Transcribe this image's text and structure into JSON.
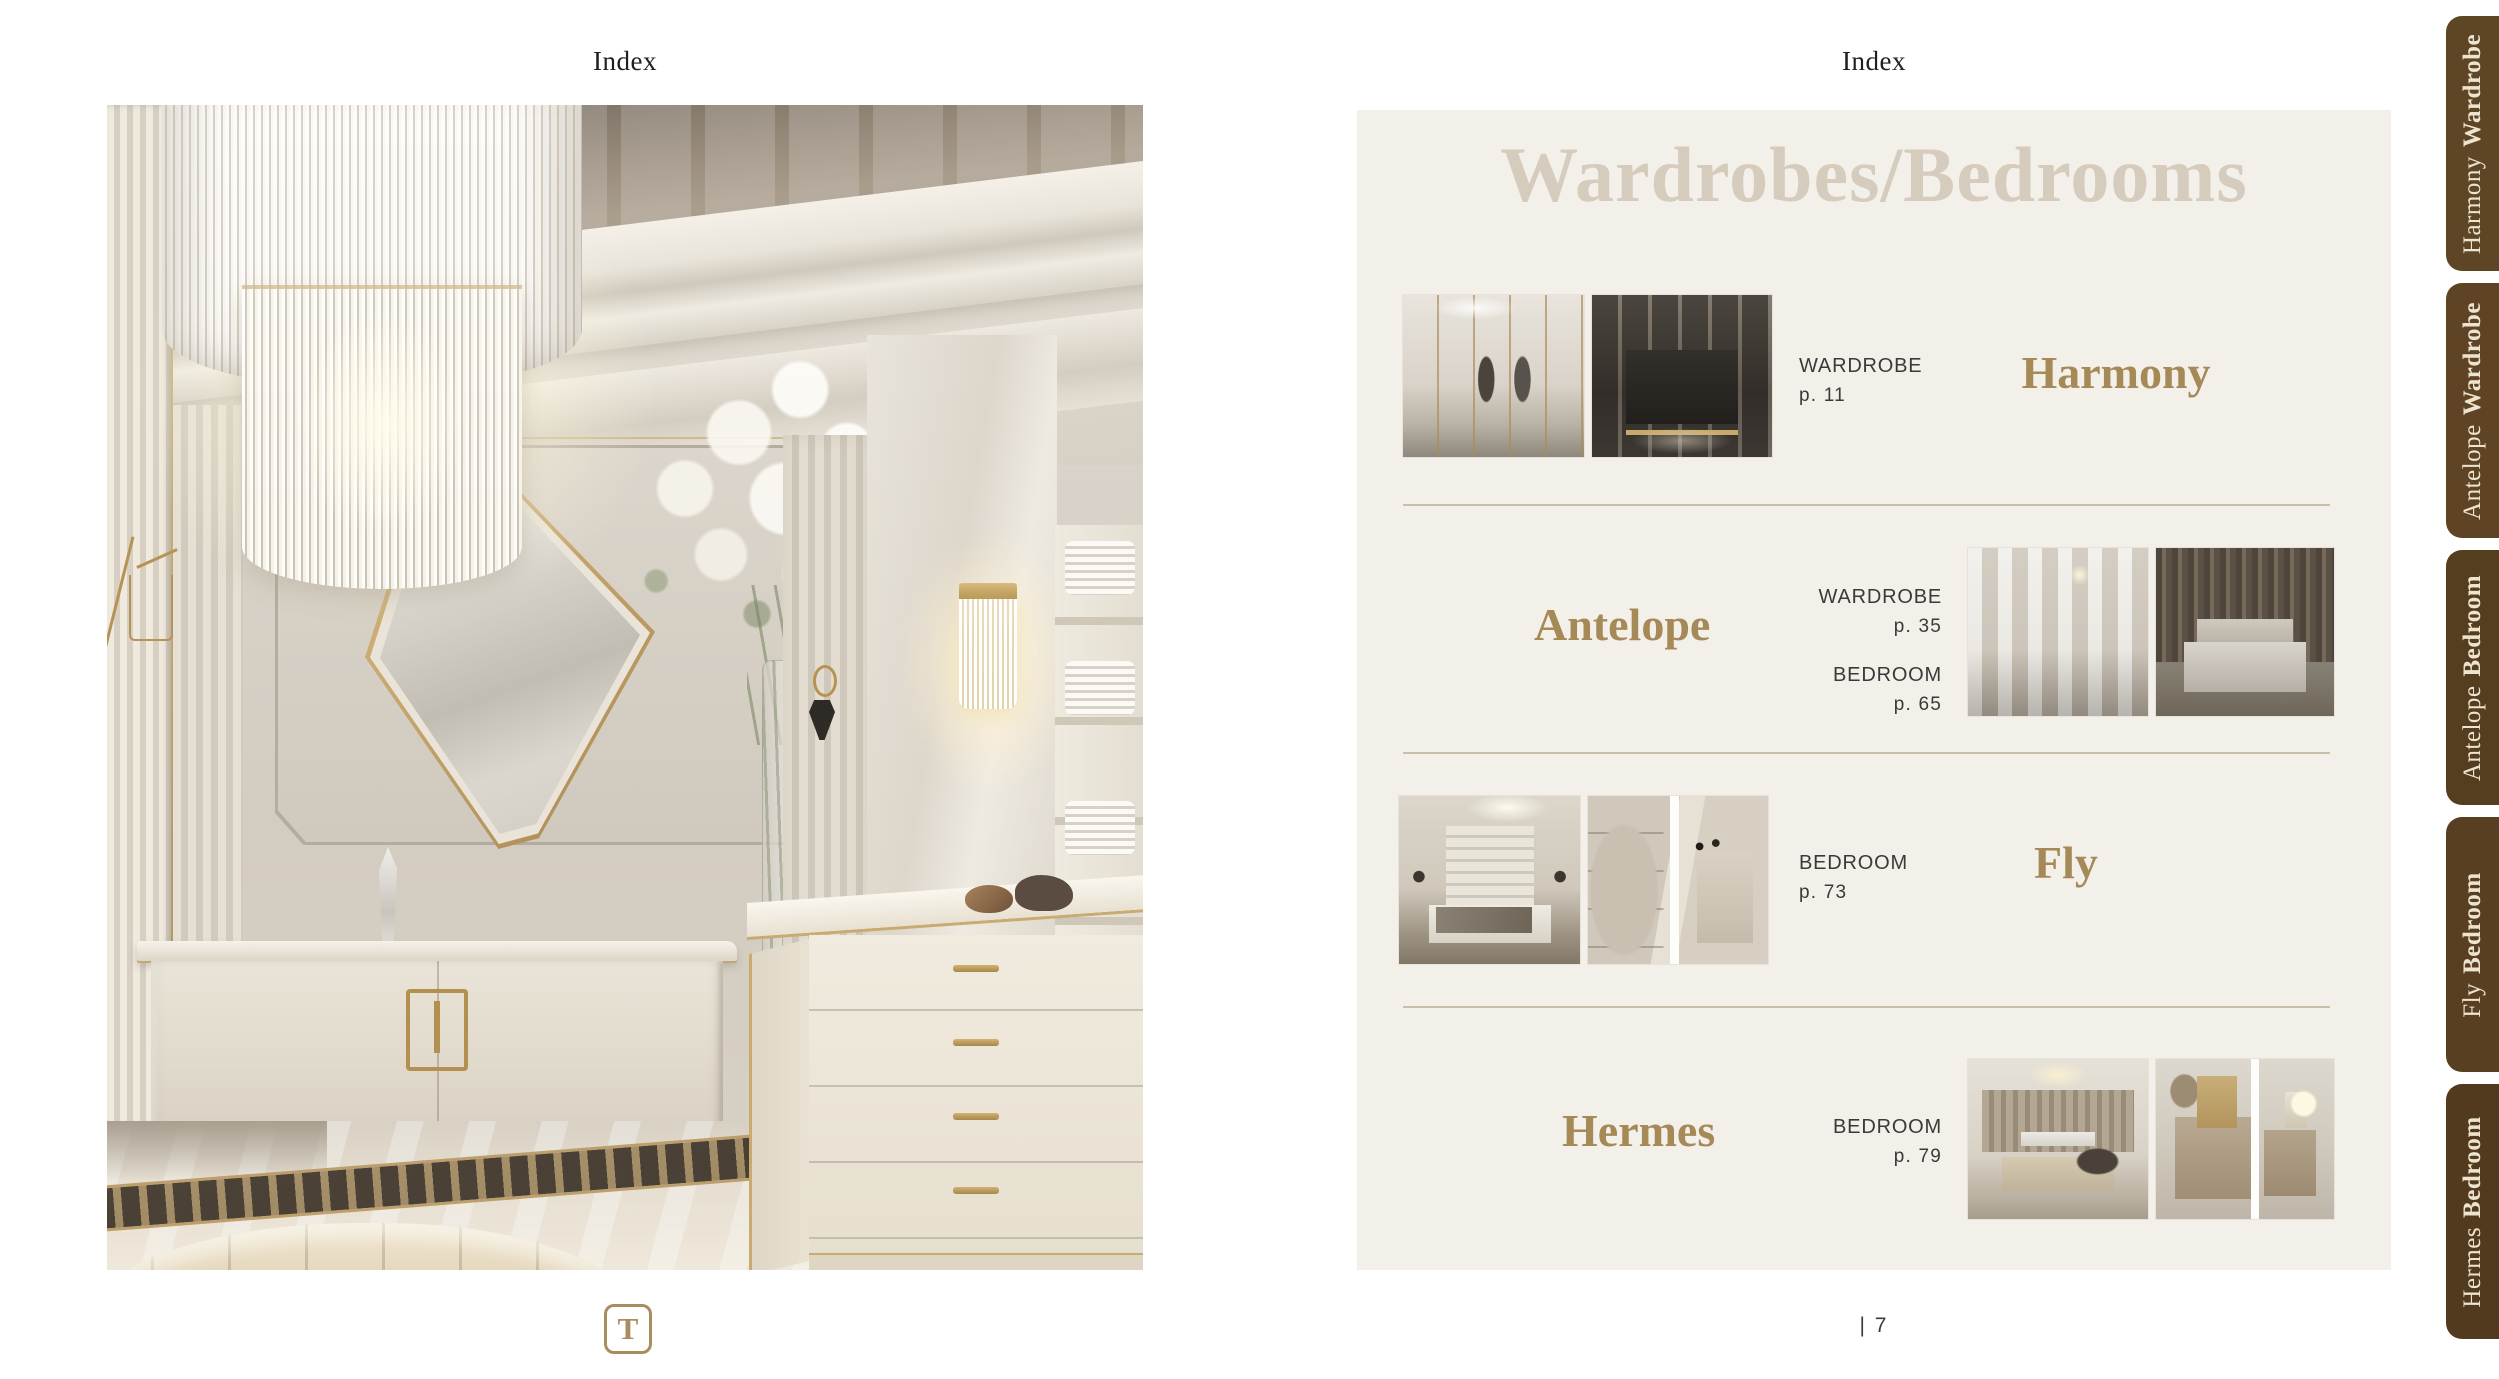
{
  "left_page": {
    "header": "Index",
    "logo": "T"
  },
  "right_page": {
    "header": "Index",
    "title": "Wardrobes/Bedrooms",
    "page_number": "| 7",
    "rows": [
      {
        "name": "Harmony",
        "entries": [
          {
            "category": "WARDROBE",
            "page": "p. 11"
          }
        ]
      },
      {
        "name": "Antelope",
        "entries": [
          {
            "category": "WARDROBE",
            "page": "p. 35"
          },
          {
            "category": "BEDROOM",
            "page": "p. 65"
          }
        ]
      },
      {
        "name": "Fly",
        "entries": [
          {
            "category": "BEDROOM",
            "page": "p. 73"
          }
        ]
      },
      {
        "name": "Hermes",
        "entries": [
          {
            "category": "BEDROOM",
            "page": "p. 79"
          }
        ]
      }
    ]
  },
  "side_tabs": [
    {
      "name": "Harmony",
      "category": "Wardrobe",
      "color": "#5d4526",
      "top": 16
    },
    {
      "name": "Antelope",
      "category": "Wardrobe",
      "color": "#5e4424",
      "top": 283
    },
    {
      "name": "Antelope",
      "category": "Bedroom",
      "color": "#553d1f",
      "top": 550
    },
    {
      "name": "Fly",
      "category": "Bedroom",
      "color": "#593f21",
      "top": 817
    },
    {
      "name": "Hermes",
      "category": "Bedroom",
      "color": "#513a1d",
      "top": 1084
    }
  ],
  "colors": {
    "accent_gold": "#a58a58",
    "panel_bg": "#f3f0ea",
    "tab_brown": "#573f21",
    "title_beige": "#d5ccbd",
    "text_dark": "#3a3a3a",
    "divider": "#c9c0a8"
  }
}
